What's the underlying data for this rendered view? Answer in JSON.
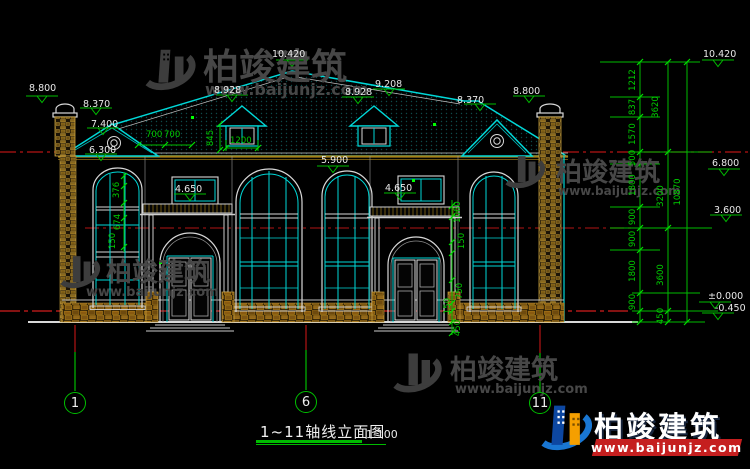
{
  "title_block": {
    "title": "1~11轴线立面图",
    "scale": "1:100"
  },
  "axis_bubbles": [
    {
      "label": "1"
    },
    {
      "label": "6"
    },
    {
      "label": "11"
    }
  ],
  "elevation_labels": [
    "8.800",
    "8.370",
    "7.400",
    "6.300",
    "8.928",
    "10.420",
    "9.208",
    "8.928",
    "8.370",
    "8.800",
    "5.900",
    "4.650",
    "4.650",
    "10.420",
    "6.800",
    "3.600",
    "±0.000",
    "-0.450"
  ],
  "dimensions": {
    "dims_top": [
      "700",
      "700",
      "1200",
      "845"
    ],
    "dims_left_window": [
      "376",
      "674",
      "150"
    ],
    "dims_entrance": [
      "1060",
      "150",
      "750",
      "150",
      "450"
    ],
    "stack_col1": [
      "1212",
      "837",
      "1570",
      "500",
      "1800",
      "900",
      "900",
      "1800",
      "900",
      "450"
    ],
    "stack_col2": [
      "3620",
      "3200",
      "3600"
    ],
    "stack_total": "10870"
  },
  "watermark": {
    "brand": "柏竣建筑",
    "url": "www.baijunjz.com"
  },
  "logo": {
    "brand": "柏竣建筑",
    "url": "www.baijunjz.com"
  },
  "colors": {
    "line": "#00d8d8",
    "dim": "#00bb00",
    "level": "#cf1f1f",
    "accent_red": "#c51f1f",
    "accent_blue": "#1976d2",
    "accent_orange": "#f59f00"
  }
}
